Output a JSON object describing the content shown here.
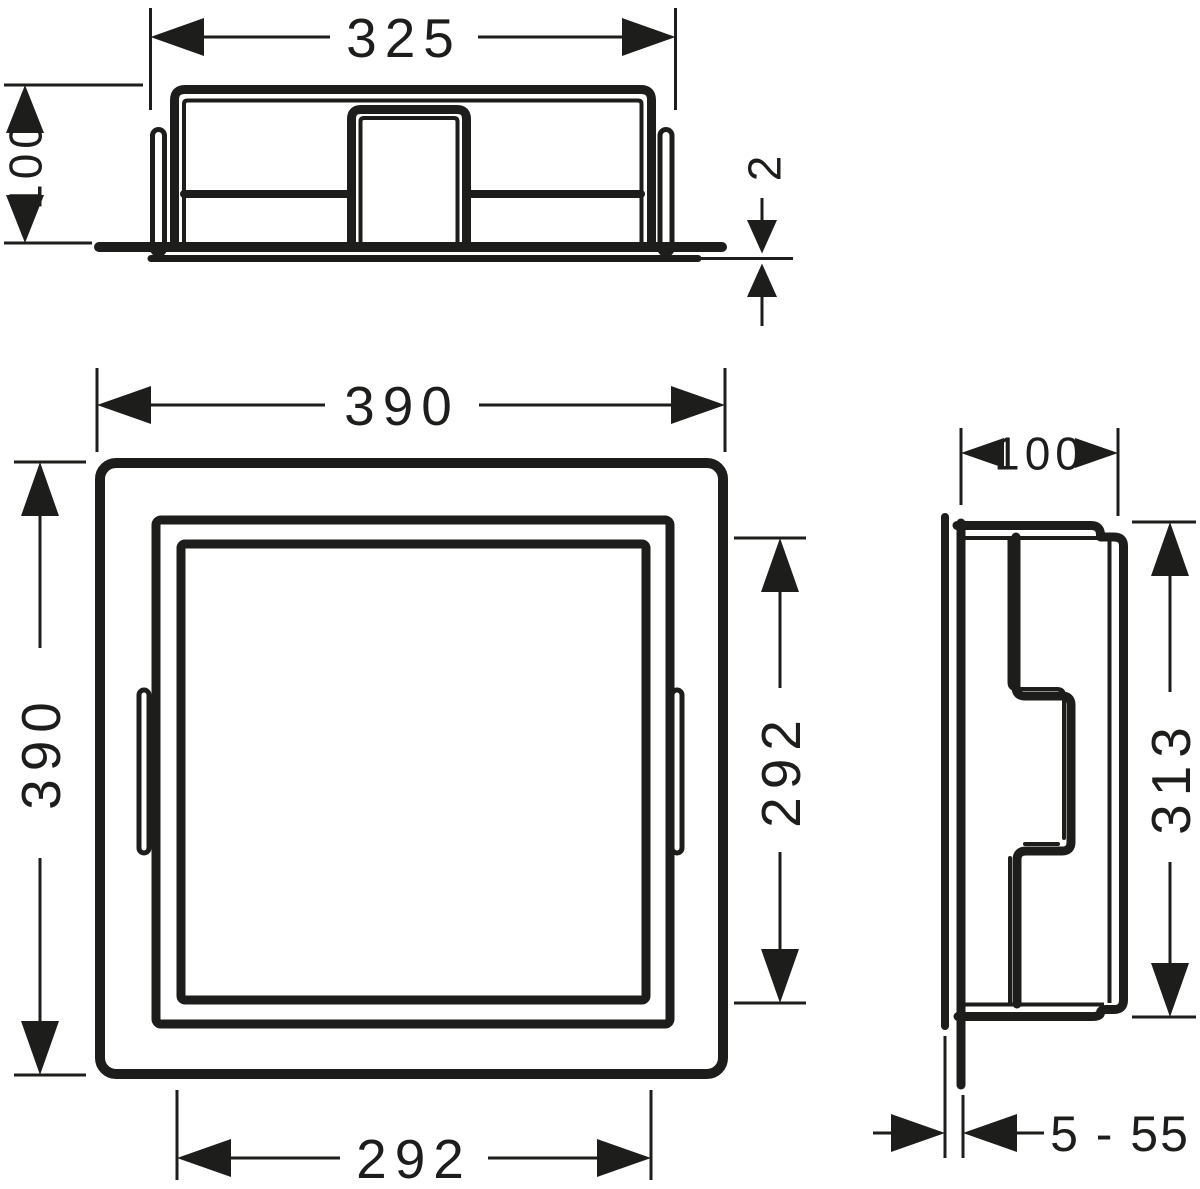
{
  "drawing": {
    "kind": "technical-dimension-drawing",
    "background_color": "#ffffff",
    "line_color": "#1d1d1b",
    "views": {
      "top": {
        "name": "top view",
        "overall_width": "325",
        "depth": "100",
        "collar_thickness": "2"
      },
      "front": {
        "name": "front view",
        "outer_width": "390",
        "outer_height": "390",
        "opening_width": "292",
        "opening_height": "292"
      },
      "side": {
        "name": "side view",
        "depth": "100",
        "height": "313",
        "tile_thickness_range": "5 - 55"
      }
    }
  }
}
